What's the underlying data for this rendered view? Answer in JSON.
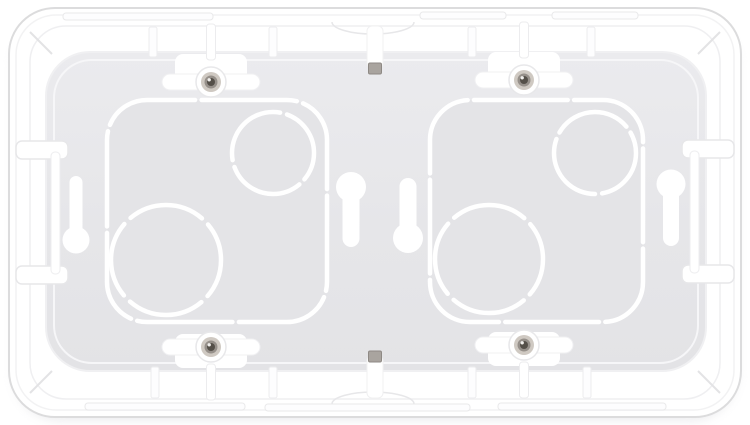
{
  "meta": {
    "description": "White plastic double-gang flush-mount electrical back box with circular cable knockouts, four fixing screws, keyhole mounting slots and cable-entry notches, photographed on a white background"
  },
  "palette": {
    "background": "#ffffff",
    "frame_white": "#ffffff",
    "frame_edge": "#dcdcdd",
    "interior_gray_light": "#ebebee",
    "interior_gray_dark": "#e3e3e6",
    "gang_gray": "#e4e4e7",
    "groove_white": "#ffffff",
    "screw_recess": "#cfc9c2",
    "screw_ring": "#96908a",
    "screw_core": "#544f48",
    "tab_gray": "#a9a49f"
  },
  "scene": {
    "shapes": [
      {
        "type": "rrect",
        "name": "page-shadow",
        "attrs": {
          "x": 13,
          "y": 17,
          "width": 725,
          "height": 404,
          "rx": 48,
          "fill": "#d8d8dd",
          "opacity": "0.45",
          "filter": "url(#soft)"
        }
      },
      {
        "type": "rrect",
        "name": "frame-outer",
        "attrs": {
          "x": 9,
          "y": 8,
          "width": 732,
          "height": 409,
          "rx": 46,
          "fill": "#ffffff",
          "stroke": "#dcdcdd",
          "stroke-width": 2
        }
      },
      {
        "type": "rrect",
        "name": "frame-inner-line",
        "attrs": {
          "x": 16,
          "y": 15,
          "width": 718,
          "height": 395,
          "rx": 40,
          "fill": "none",
          "stroke": "#f2f2f3",
          "stroke-width": 1.5
        }
      },
      {
        "type": "rrect",
        "name": "rim-inner-edge",
        "attrs": {
          "x": 30,
          "y": 26,
          "width": 690,
          "height": 373,
          "rx": 36,
          "fill": "none",
          "stroke": "#efeff1",
          "stroke-width": 1.5
        }
      },
      {
        "type": "line",
        "name": "corner-tick-top-left",
        "attrs": {
          "x1": 30,
          "y1": 32,
          "x2": 52,
          "y2": 54,
          "stroke": "#e3e3e5",
          "stroke-width": 2
        }
      },
      {
        "type": "line",
        "name": "corner-tick-top-right",
        "attrs": {
          "x1": 720,
          "y1": 32,
          "x2": 698,
          "y2": 54,
          "stroke": "#e3e3e5",
          "stroke-width": 2
        }
      },
      {
        "type": "line",
        "name": "corner-tick-bottom-left",
        "attrs": {
          "x1": 30,
          "y1": 393,
          "x2": 52,
          "y2": 371,
          "stroke": "#e3e3e5",
          "stroke-width": 2
        }
      },
      {
        "type": "line",
        "name": "corner-tick-bottom-right",
        "attrs": {
          "x1": 720,
          "y1": 393,
          "x2": 698,
          "y2": 371,
          "stroke": "#e3e3e5",
          "stroke-width": 2
        }
      },
      {
        "type": "rrect",
        "name": "rim-groove-top-1",
        "attrs": {
          "x": 63,
          "y": 13,
          "width": 150,
          "height": 7,
          "rx": 3,
          "fill": "#fdfdfe",
          "stroke": "#e9e9ea",
          "stroke-width": 1
        }
      },
      {
        "type": "rrect",
        "name": "rim-groove-top-2",
        "attrs": {
          "x": 420,
          "y": 12,
          "width": 86,
          "height": 7,
          "rx": 3,
          "fill": "#fdfdfe",
          "stroke": "#e9e9ea",
          "stroke-width": 1
        }
      },
      {
        "type": "rrect",
        "name": "rim-groove-top-3",
        "attrs": {
          "x": 552,
          "y": 12,
          "width": 86,
          "height": 7,
          "rx": 3,
          "fill": "#fdfdfe",
          "stroke": "#e9e9ea",
          "stroke-width": 1
        }
      },
      {
        "type": "rrect",
        "name": "rim-groove-bottom-1",
        "attrs": {
          "x": 85,
          "y": 403,
          "width": 160,
          "height": 7,
          "rx": 3,
          "fill": "#fdfdfe",
          "stroke": "#e9e9ea",
          "stroke-width": 1
        }
      },
      {
        "type": "rrect",
        "name": "rim-groove-bottom-2",
        "attrs": {
          "x": 265,
          "y": 404,
          "width": 205,
          "height": 7,
          "rx": 3,
          "fill": "#fdfdfe",
          "stroke": "#e9e9ea",
          "stroke-width": 1
        }
      },
      {
        "type": "rrect",
        "name": "rim-groove-bottom-3",
        "attrs": {
          "x": 498,
          "y": 403,
          "width": 168,
          "height": 7,
          "rx": 3,
          "fill": "#fdfdfe",
          "stroke": "#e9e9ea",
          "stroke-width": 1
        }
      },
      {
        "type": "rrect",
        "name": "interior-back-plate",
        "attrs": {
          "x": 46,
          "y": 52,
          "width": 660,
          "height": 319,
          "rx": 44,
          "fill": "url(#gradInterior)",
          "stroke": "#f0f0f2",
          "stroke-width": 2
        }
      },
      {
        "type": "rrect",
        "name": "interior-wall-highlight",
        "attrs": {
          "x": 54,
          "y": 60,
          "width": 644,
          "height": 303,
          "rx": 38,
          "fill": "none",
          "stroke": "#f6f6f8",
          "stroke-width": 2
        }
      },
      {
        "type": "rrect",
        "name": "gang-section-left",
        "attrs": {
          "x": 107,
          "y": 100,
          "width": 220,
          "height": 222,
          "rx": 40,
          "fill": "#e4e4e7"
        }
      },
      {
        "type": "rrect",
        "name": "gang-section-right",
        "attrs": {
          "x": 430,
          "y": 100,
          "width": 213,
          "height": 222,
          "rx": 40,
          "fill": "#e4e4e7"
        }
      },
      {
        "type": "rrect",
        "name": "gang-outline-left",
        "attrs": {
          "x": 107,
          "y": 100,
          "width": 220,
          "height": 222,
          "rx": 40,
          "fill": "none",
          "stroke": "#ffffff",
          "stroke-width": 4.5,
          "pathLength": 1000,
          "stroke-dasharray": "117 8",
          "stroke-dashoffset": 58,
          "stroke-linecap": "round"
        }
      },
      {
        "type": "rrect",
        "name": "gang-outline-right",
        "attrs": {
          "x": 430,
          "y": 100,
          "width": 213,
          "height": 222,
          "rx": 40,
          "fill": "none",
          "stroke": "#ffffff",
          "stroke-width": 4.5,
          "pathLength": 1000,
          "stroke-dasharray": "117 8",
          "stroke-dashoffset": 120,
          "stroke-linecap": "round"
        }
      },
      {
        "type": "circle",
        "name": "knockout-circle-large-left",
        "attrs": {
          "cx": 166,
          "cy": 260,
          "r": 55,
          "fill": "none",
          "stroke": "#ffffff",
          "stroke-width": 4.5,
          "pathLength": 360,
          "stroke-dasharray": "81 9",
          "stroke-dashoffset": 40,
          "stroke-linecap": "round"
        }
      },
      {
        "type": "circle",
        "name": "knockout-circle-small-left",
        "attrs": {
          "cx": 273,
          "cy": 153,
          "r": 41,
          "fill": "none",
          "stroke": "#ffffff",
          "stroke-width": 4.5,
          "pathLength": 360,
          "stroke-dasharray": "110 10",
          "stroke-dashoffset": 70,
          "stroke-linecap": "round"
        }
      },
      {
        "type": "circle",
        "name": "knockout-circle-large-right",
        "attrs": {
          "cx": 489,
          "cy": 259,
          "r": 54,
          "fill": "none",
          "stroke": "#ffffff",
          "stroke-width": 4.5,
          "pathLength": 360,
          "stroke-dasharray": "81 9",
          "stroke-dashoffset": 130,
          "stroke-linecap": "round"
        }
      },
      {
        "type": "circle",
        "name": "knockout-circle-small-right",
        "attrs": {
          "cx": 595,
          "cy": 153,
          "r": 41,
          "fill": "none",
          "stroke": "#ffffff",
          "stroke-width": 4.5,
          "pathLength": 360,
          "stroke-dasharray": "110 10",
          "stroke-dashoffset": 150,
          "stroke-linecap": "round"
        }
      },
      {
        "type": "rrect",
        "name": "rim-slot-left-upper",
        "attrs": {
          "x": 16,
          "y": 141,
          "width": 52,
          "height": 18,
          "rx": 6,
          "fill": "#ffffff",
          "stroke": "#e7e7e9",
          "stroke-width": 1.5
        }
      },
      {
        "type": "rrect",
        "name": "rim-slot-left-lower",
        "attrs": {
          "x": 16,
          "y": 266,
          "width": 52,
          "height": 18,
          "rx": 6,
          "fill": "#ffffff",
          "stroke": "#e7e7e9",
          "stroke-width": 1.5
        }
      },
      {
        "type": "rrect",
        "name": "rim-slot-left-vertical",
        "attrs": {
          "x": 51,
          "y": 152,
          "width": 9,
          "height": 122,
          "rx": 4,
          "fill": "#ffffff",
          "stroke": "#ededef",
          "stroke-width": 1
        }
      },
      {
        "type": "rrect",
        "name": "rim-slot-right-upper",
        "attrs": {
          "x": 682,
          "y": 140,
          "width": 52,
          "height": 18,
          "rx": 6,
          "fill": "#ffffff",
          "stroke": "#e7e7e9",
          "stroke-width": 1.5
        }
      },
      {
        "type": "rrect",
        "name": "rim-slot-right-lower",
        "attrs": {
          "x": 682,
          "y": 265,
          "width": 52,
          "height": 18,
          "rx": 6,
          "fill": "#ffffff",
          "stroke": "#e7e7e9",
          "stroke-width": 1.5
        }
      },
      {
        "type": "rrect",
        "name": "rim-slot-right-vertical",
        "attrs": {
          "x": 690,
          "y": 151,
          "width": 9,
          "height": 122,
          "rx": 4,
          "fill": "#ffffff",
          "stroke": "#ededef",
          "stroke-width": 1
        }
      },
      {
        "type": "rrect",
        "name": "rib-top-1",
        "attrs": {
          "x": 149,
          "y": 27,
          "width": 8,
          "height": 30,
          "rx": 2,
          "fill": "#fdfdfe",
          "stroke": "#ececee",
          "stroke-width": 1
        }
      },
      {
        "type": "rrect",
        "name": "rib-top-2",
        "attrs": {
          "x": 269,
          "y": 27,
          "width": 8,
          "height": 30,
          "rx": 2,
          "fill": "#fdfdfe",
          "stroke": "#ececee",
          "stroke-width": 1
        }
      },
      {
        "type": "rrect",
        "name": "rib-top-3",
        "attrs": {
          "x": 468,
          "y": 27,
          "width": 8,
          "height": 30,
          "rx": 2,
          "fill": "#fdfdfe",
          "stroke": "#ececee",
          "stroke-width": 1
        }
      },
      {
        "type": "rrect",
        "name": "rib-top-4",
        "attrs": {
          "x": 587,
          "y": 27,
          "width": 8,
          "height": 30,
          "rx": 2,
          "fill": "#fdfdfe",
          "stroke": "#ececee",
          "stroke-width": 1
        }
      },
      {
        "type": "rrect",
        "name": "rib-bottom-1",
        "attrs": {
          "x": 151,
          "y": 367,
          "width": 8,
          "height": 31,
          "rx": 2,
          "fill": "#fdfdfe",
          "stroke": "#ececee",
          "stroke-width": 1
        }
      },
      {
        "type": "rrect",
        "name": "rib-bottom-2",
        "attrs": {
          "x": 269,
          "y": 367,
          "width": 8,
          "height": 31,
          "rx": 2,
          "fill": "#fdfdfe",
          "stroke": "#ececee",
          "stroke-width": 1
        }
      },
      {
        "type": "rrect",
        "name": "rib-bottom-3",
        "attrs": {
          "x": 468,
          "y": 367,
          "width": 8,
          "height": 31,
          "rx": 2,
          "fill": "#fdfdfe",
          "stroke": "#ececee",
          "stroke-width": 1
        }
      },
      {
        "type": "rrect",
        "name": "rib-bottom-4",
        "attrs": {
          "x": 583,
          "y": 367,
          "width": 8,
          "height": 31,
          "rx": 2,
          "fill": "#fdfdfe",
          "stroke": "#ececee",
          "stroke-width": 1
        }
      },
      {
        "type": "path",
        "name": "rim-oval-detail-top",
        "attrs": {
          "d": "M332,22 A41,12 0 0 0 414,22",
          "fill": "none",
          "stroke": "#e7e7e9",
          "stroke-width": 1.5
        }
      },
      {
        "type": "path",
        "name": "rim-oval-detail-bottom",
        "attrs": {
          "d": "M332,404 A41,12 0 0 1 414,404",
          "fill": "none",
          "stroke": "#e7e7e9",
          "stroke-width": 1.5
        }
      },
      {
        "type": "rrect",
        "name": "cable-notch-slot-top",
        "attrs": {
          "x": 367,
          "y": 26,
          "width": 16,
          "height": 42,
          "rx": 5,
          "fill": "#ffffff",
          "stroke": "#f0f0f1",
          "stroke-width": 1
        }
      },
      {
        "type": "rrect",
        "name": "cable-notch-tab-top",
        "attrs": {
          "x": 368.5,
          "y": 63,
          "width": 13,
          "height": 11,
          "rx": 1.5,
          "fill": "#a9a49f",
          "stroke": "#8e8984",
          "stroke-width": 1
        }
      },
      {
        "type": "rrect",
        "name": "cable-notch-slot-bottom",
        "attrs": {
          "x": 367,
          "y": 356,
          "width": 16,
          "height": 42,
          "rx": 5,
          "fill": "#ffffff",
          "stroke": "#f0f0f1",
          "stroke-width": 1
        }
      },
      {
        "type": "rrect",
        "name": "cable-notch-tab-bottom",
        "attrs": {
          "x": 368.5,
          "y": 351,
          "width": 13,
          "height": 11,
          "rx": 1.5,
          "fill": "#a9a49f",
          "stroke": "#8e8984",
          "stroke-width": 1
        }
      }
    ],
    "keyholes": [
      {
        "name": "keyhole-slot-far-left",
        "cx": 76,
        "stem_w": 13,
        "stem_y1": 176,
        "stem_y2": 244,
        "circle_cy": 240,
        "r": 13.5
      },
      {
        "name": "keyhole-slot-center-left",
        "cx": 351,
        "stem_w": 17,
        "stem_y1": 184,
        "stem_y2": 247,
        "circle_cy": 187,
        "r": 15
      },
      {
        "name": "keyhole-slot-center-right",
        "cx": 408,
        "stem_w": 17,
        "stem_y1": 178,
        "stem_y2": 240,
        "circle_cy": 238,
        "r": 15
      },
      {
        "name": "keyhole-slot-far-right",
        "cx": 671,
        "stem_w": 16,
        "stem_y1": 182,
        "stem_y2": 246,
        "circle_cy": 184,
        "r": 14.5
      }
    ],
    "screws": [
      {
        "name": "fixing-screw-top-left",
        "cx": 211,
        "cy": 82,
        "dir": "up"
      },
      {
        "name": "fixing-screw-top-right",
        "cx": 524,
        "cy": 80,
        "dir": "up"
      },
      {
        "name": "fixing-screw-bottom-left",
        "cx": 211,
        "cy": 347,
        "dir": "down"
      },
      {
        "name": "fixing-screw-bottom-right",
        "cx": 524,
        "cy": 345,
        "dir": "down"
      }
    ],
    "screw_style": {
      "boss_r": 15,
      "boss_fill": "#ffffff",
      "boss_stroke": "#e8e8ea",
      "recess_r": 10,
      "recess_fill": "#cfc9c2",
      "ring_r": 6.5,
      "ring_fill": "#96908a",
      "core_r": 4,
      "core_fill": "#544f48",
      "highlight_r": 1.7,
      "highlight_fill": "#f1efec",
      "notch_fill": "#ffffff",
      "bar_stroke": "#f0f0f2",
      "stem_stroke": "#ececee"
    },
    "keyhole_fill": "#ffffff"
  }
}
